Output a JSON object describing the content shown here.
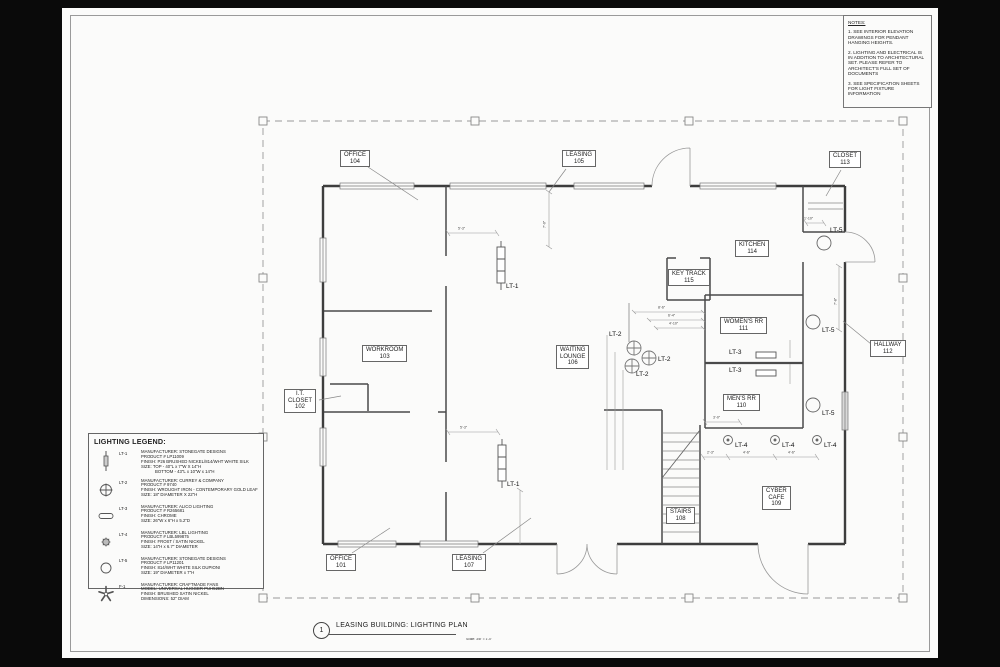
{
  "notes": {
    "title": "NOTES:",
    "items": [
      "1. SEE INTERIOR ELEVATION DRAWINGS FOR PENDANT HANGING HEIGHTS.",
      "2. LIGHTING AND ELECTRICAL IS IN ADDITION TO ARCHITECTURAL SET.  PLEASE REFER TO ARCHITECT'S FULL SET OF DOCUMENTS",
      "3. SEE SPECIFICATION SHEETS FOR LIGHT FIXTURE INFORMATION"
    ]
  },
  "legend": {
    "title": "LIGHTING LEGEND:",
    "entries": [
      {
        "id": "LT-1",
        "symbol": "linear-pendant",
        "lines": [
          "MANUFACTURER: STONEGATE DESIGNS",
          "PRODUCT # LP11009",
          "FINISH: P26 BRUSHED NICKEL/814/WHT WHITE SILK",
          "SIZE: TOP - 40\"L x 7\"W X 14\"H",
          "BOTTOM - 43\"L x 10\"W x 14\"H"
        ]
      },
      {
        "id": "LT-2",
        "symbol": "crosshair-pendant",
        "lines": [
          "MANUFACTURER: CURREY & COMPANY",
          "PRODUCT # 9740",
          "FINISH: WROUGHT IRON - CONTEMPORARY GOLD LEAF",
          "SIZE: 18\" DIAMETER X 22\"H"
        ]
      },
      {
        "id": "LT-3",
        "symbol": "wall-bar",
        "lines": [
          "MANUFACTURER: ALICO LIGHTING",
          "PRODUCT # R265681",
          "FINISH: CHROME",
          "SIZE: 26\"W x 6\"H x 5.2\"D"
        ]
      },
      {
        "id": "LT-4",
        "symbol": "small-pendant",
        "lines": [
          "MANUFACTURER: LBL LIGHTING",
          "PRODUCT # LBL599875",
          "FINISH: FROST / SATIN NICKEL",
          "SIZE: 14\"H x 6.7\" DIAMETER"
        ]
      },
      {
        "id": "LT-5",
        "symbol": "round-flushmount",
        "lines": [
          "MANUFACTURER: STONEGATE DESIGNS",
          "PRODUCT # LP11201",
          "FINISH: 814/WHT WHITE SILK DUPIONI",
          "SIZE: 19\" DIAMETER x 7\"H"
        ]
      },
      {
        "id": "F-1",
        "symbol": "ceiling-fan",
        "lines": [
          "MANUFACTURER: CRAFTMADE FANS",
          "MODEL: UNIVERSAL HUGGER PUH52BN",
          "FINISH: BRUSHED SATIN NICKEL",
          "DIMENSIONS: 52\" DIAM"
        ]
      }
    ]
  },
  "plan": {
    "rooms": {
      "office_104": {
        "lines": [
          "OFFICE",
          "104"
        ]
      },
      "leasing_105": {
        "lines": [
          "LEASING",
          "105"
        ]
      },
      "closet_113": {
        "lines": [
          "CLOSET",
          "113"
        ]
      },
      "kitchen_114": {
        "lines": [
          "KITCHEN",
          "114"
        ]
      },
      "key_track_115": {
        "lines": [
          "KEY TRACK",
          "115"
        ]
      },
      "womens_rr_111": {
        "lines": [
          "WOMEN'S RR",
          "111"
        ]
      },
      "mens_rr_110": {
        "lines": [
          "MEN'S RR",
          "110"
        ]
      },
      "waiting_106": {
        "lines": [
          "WAITING",
          "LOUNGE",
          "106"
        ]
      },
      "hallway_112": {
        "lines": [
          "HALLWAY",
          "112"
        ]
      },
      "cyber_109": {
        "lines": [
          "CYBER",
          "CAFE",
          "109"
        ]
      },
      "stairs_108": {
        "lines": [
          "STAIRS",
          "108"
        ]
      },
      "workroom_103": {
        "lines": [
          "WORKROOM",
          "103"
        ]
      },
      "it_closet_102": {
        "lines": [
          "I.T.",
          "CLOSET",
          "102"
        ]
      },
      "office_101": {
        "lines": [
          "OFFICE",
          "101"
        ]
      },
      "leasing_107": {
        "lines": [
          "LEASING",
          "107"
        ]
      }
    },
    "fixture_labels": [
      "LT-1",
      "LT-1",
      "LT-2",
      "LT-2",
      "LT-2",
      "LT-3",
      "LT-3",
      "LT-4",
      "LT-4",
      "LT-4",
      "LT-5",
      "LT-5",
      "LT-5"
    ],
    "dims": [
      "5'-3\"",
      "7'-0\"",
      "1'-10\"",
      "7'-8\"",
      "8'-6\"",
      "6'-4\"",
      "4'-10\"",
      "2'-3\"",
      "4'-6\"",
      "4'-6\"",
      "5'-3\"",
      "3'-0\""
    ]
  },
  "title_block": {
    "number": "1",
    "title": "LEASING BUILDING: LIGHTING PLAN",
    "scale": "Scale: 3/8\" = 1'-0\""
  }
}
